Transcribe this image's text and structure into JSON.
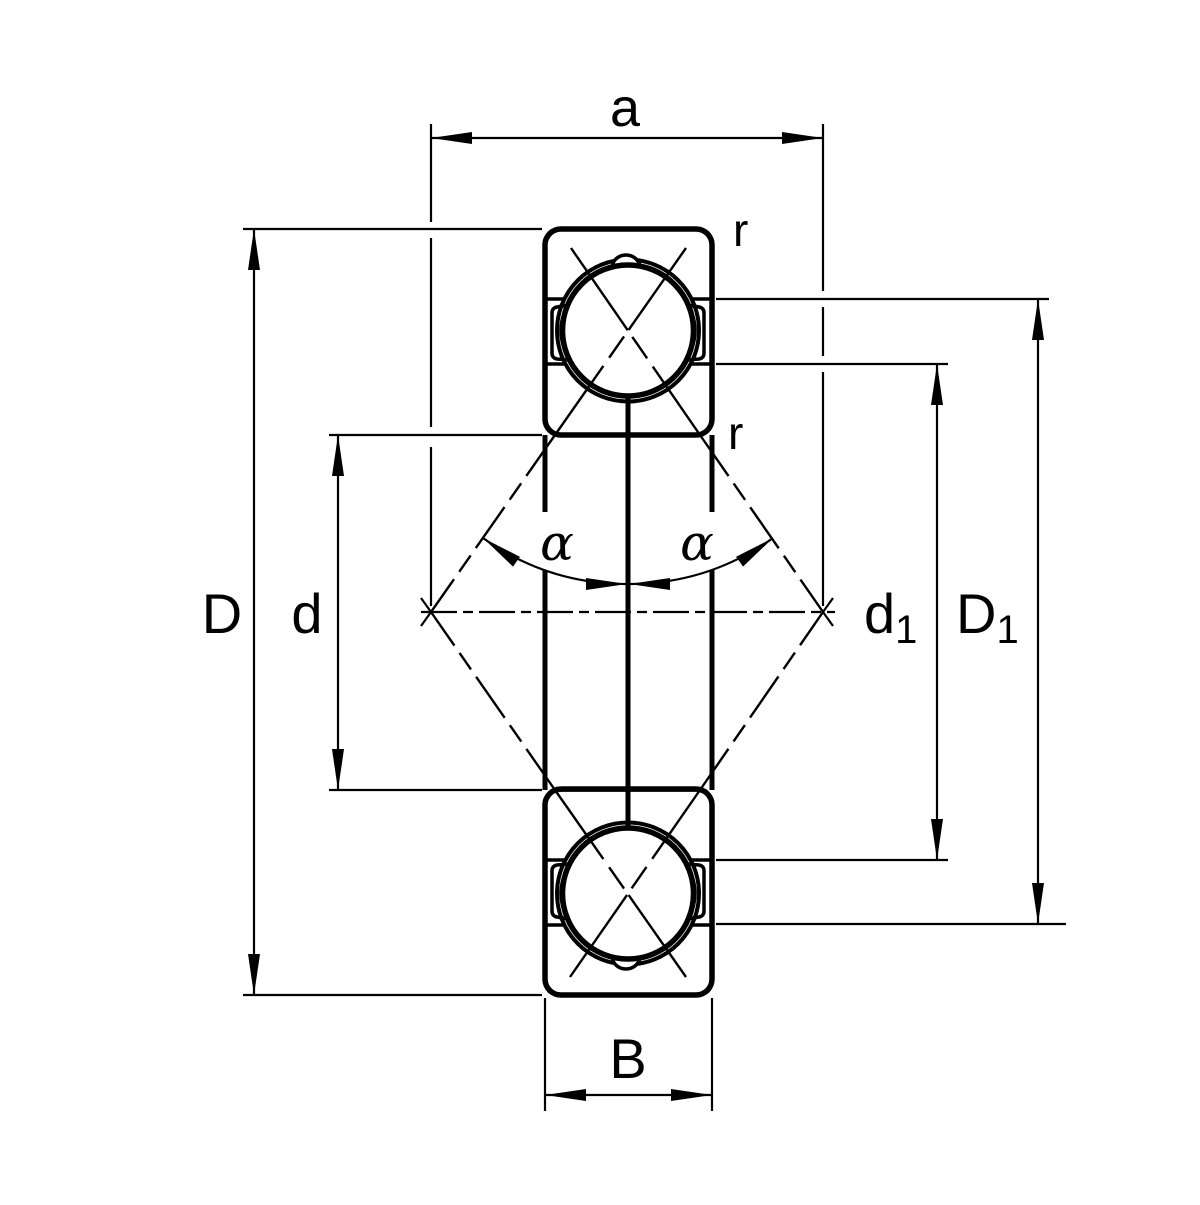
{
  "diagram": {
    "background_color": "#ffffff",
    "ink_color": "#000000",
    "labels": {
      "a": "a",
      "outer_diameter": "D",
      "bore_diameter": "d",
      "inner_shoulder_base": "d",
      "inner_shoulder_sub": "1",
      "outer_shoulder_base": "D",
      "outer_shoulder_sub": "1",
      "width": "B",
      "chamfer_top": "r",
      "chamfer_mid": "r",
      "contact_angle_left": "α",
      "contact_angle_right": "α"
    }
  }
}
